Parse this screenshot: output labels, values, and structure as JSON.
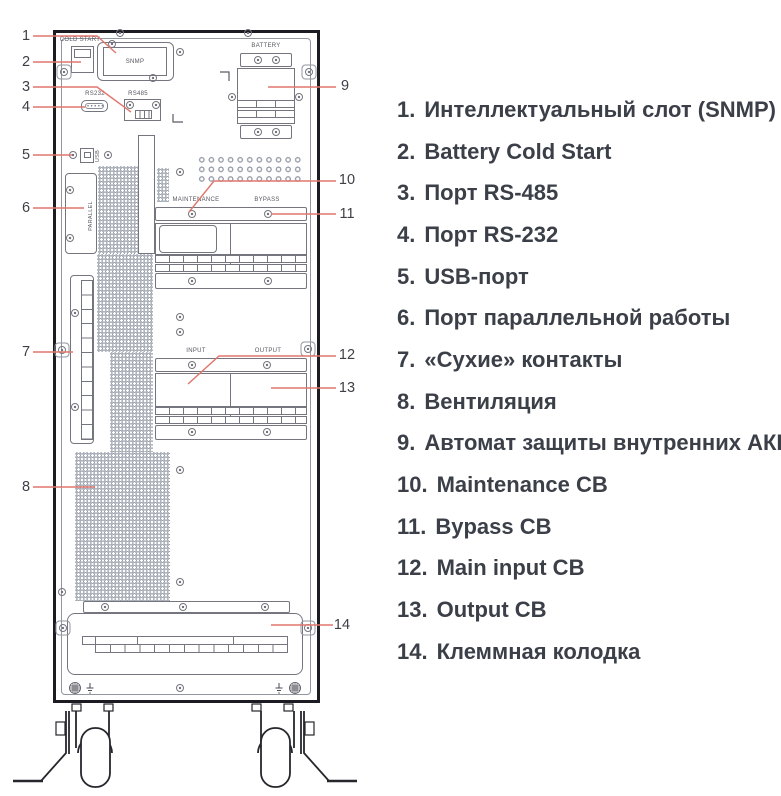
{
  "diagram": {
    "title": "UPS rear panel",
    "panel_labels": {
      "cold_start": "COLD START",
      "snmp": "SNMP",
      "rs232": "RS232",
      "rs485": "RS485",
      "battery": "BATTERY",
      "usb": "USB",
      "parallel": "PARALLEL",
      "maintenance": "MAINTENANCE",
      "bypass": "BYPASS",
      "input": "INPUT",
      "output": "OUTPUT"
    },
    "callouts": [
      "1",
      "2",
      "3",
      "4",
      "5",
      "6",
      "7",
      "8",
      "9",
      "10",
      "11",
      "12",
      "13",
      "14"
    ]
  },
  "legend": {
    "items": [
      {
        "num": "1.",
        "label": "Интеллектуальный слот (SNMP)"
      },
      {
        "num": "2.",
        "label": "Battery Cold Start"
      },
      {
        "num": "3.",
        "label": "Порт RS-485"
      },
      {
        "num": "4.",
        "label": "Порт RS-232"
      },
      {
        "num": "5.",
        "label": "USB-порт"
      },
      {
        "num": "6.",
        "label": "Порт параллельной работы"
      },
      {
        "num": "7.",
        "label": "«Сухие» контакты"
      },
      {
        "num": "8.",
        "label": "Вентиляция"
      },
      {
        "num": "9.",
        "label": "Автомат защиты внутренних АКБ"
      },
      {
        "num": "10.",
        "label": "Maintenance CB"
      },
      {
        "num": "11.",
        "label": "Bypass CB"
      },
      {
        "num": "12.",
        "label": "Main input CB"
      },
      {
        "num": "13.",
        "label": "Output CB"
      },
      {
        "num": "14.",
        "label": "Клеммная колодка"
      }
    ]
  },
  "colors": {
    "leader_line": "#e0766c",
    "drawing_line": "#75757f",
    "cabinet_border": "#1b1b21",
    "text": "#3b3f48"
  }
}
